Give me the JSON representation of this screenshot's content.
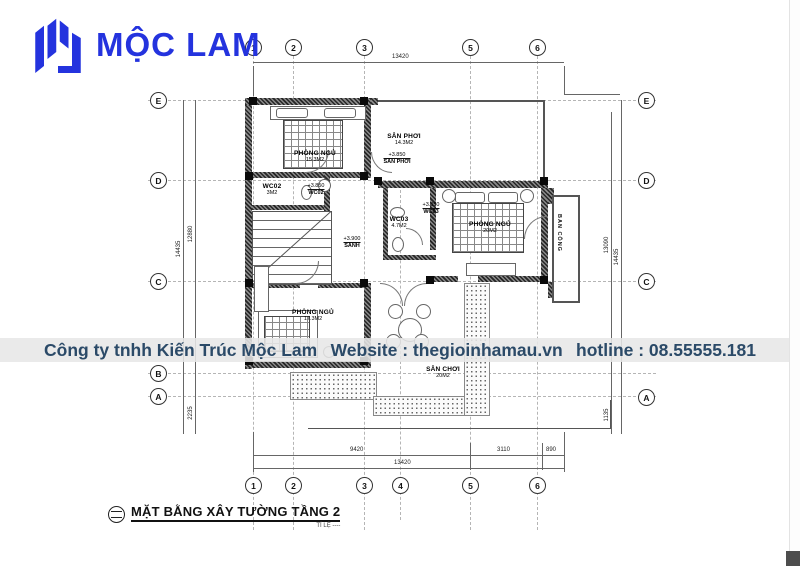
{
  "logo": {
    "text": "MỘC LAM",
    "color": "#2433de"
  },
  "watermark": {
    "company": "Công ty tnhh Kiến Trúc Mộc Lam",
    "website": "Website : thegioinhamau.vn",
    "hotline": "hotline : 08.55555.181",
    "text_color": "#2b4a68",
    "band_color": "#e7e7e7"
  },
  "title_block": {
    "title": "MẶT BẰNG XÂY TƯỜNG TẦNG 2",
    "scale_label": "TỈ LỆ ----"
  },
  "axes": {
    "top": [
      "1",
      "2",
      "3",
      "5",
      "6"
    ],
    "bottom": [
      "1",
      "2",
      "3",
      "4",
      "5",
      "6"
    ],
    "left": [
      "E",
      "D",
      "C",
      "B",
      "A"
    ],
    "right": [
      "E",
      "D",
      "C",
      "A"
    ]
  },
  "dimensions": {
    "top_total": "13420",
    "bottom_segments": [
      "9420",
      "3110",
      "890"
    ],
    "bottom_total": "13420",
    "left_outer": "14435",
    "left_inner": "12880",
    "left_bottom": "2235",
    "right_outer": "14435",
    "right_inner": "13090",
    "right_bottom": "1135"
  },
  "rooms": {
    "bedroom_tl": {
      "name": "PHÒNG NGỦ",
      "area": "15.3M2"
    },
    "laundry": {
      "name": "SÂN PHƠI",
      "area": "14.3M2"
    },
    "bedroom_r": {
      "name": "PHÒNG NGỦ",
      "area": "20M2"
    },
    "balcony": {
      "name": "BAN CÔNG"
    },
    "wc02a": {
      "name": "WC02",
      "area": "3M2"
    },
    "wc02b": {
      "name": "WC02"
    },
    "wc03": {
      "name": "WC03",
      "area": "4.7M2"
    },
    "bedroom_bl": {
      "name": "PHÒNG NGỦ",
      "area": "17.3M2"
    },
    "playground": {
      "name": "SÂN CHƠI",
      "area": "20M2"
    }
  },
  "levels": {
    "laundry": {
      "value": "+3.850",
      "label": "SÂN PHƠI"
    },
    "wc02": {
      "value": "+3.850",
      "label": "WC02"
    },
    "wc03": {
      "value": "+3.850",
      "label": "WC03"
    },
    "hall": {
      "value": "+3.900",
      "label": "SẢNH"
    }
  }
}
